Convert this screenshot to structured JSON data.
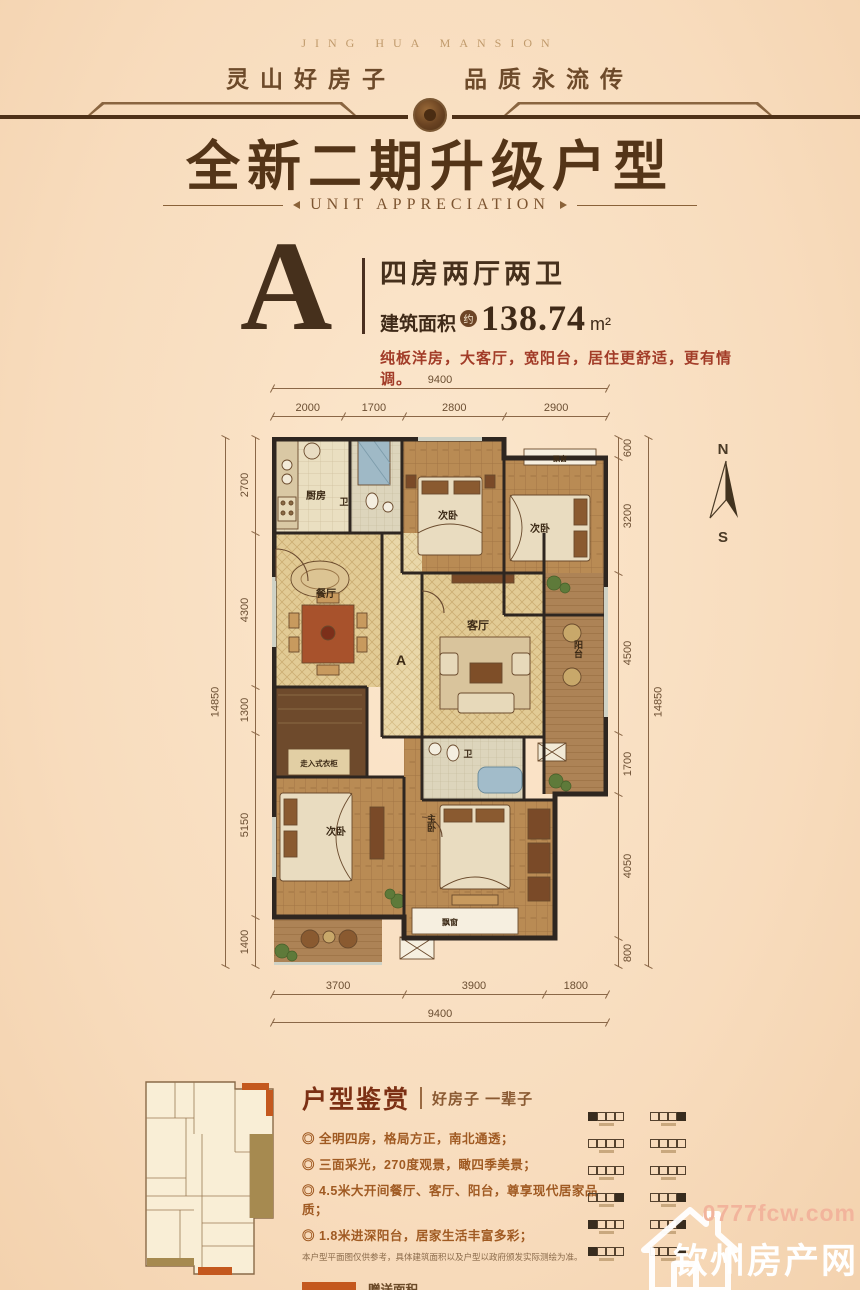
{
  "header": {
    "brand_en": "JING HUA MANSION",
    "tagline": "灵山好房子　　品质永流传",
    "title": "全新二期升级户型",
    "subtitle": "UNIT APPRECIATION"
  },
  "unit": {
    "letter": "A",
    "layout": "四房两厅两卫",
    "area_label": "建筑面积",
    "area_approx": "约",
    "area_value": "138.74",
    "area_unit": "m²",
    "description": "纯板洋房，大客厅，宽阳台，居住更舒适，更有情调。"
  },
  "floor_plan": {
    "compass": {
      "north": "N",
      "south": "S"
    },
    "dimensions": {
      "top_total": "9400",
      "top_segments": [
        "2000",
        "1700",
        "2800",
        "2900"
      ],
      "left_total": "14850",
      "left_segments": [
        "2700",
        "4300",
        "1300",
        "5150",
        "1400"
      ],
      "right_total": "14850",
      "right_segments": [
        "600",
        "3200",
        "4500",
        "1700",
        "4050",
        "800"
      ],
      "bottom_segments": [
        "3700",
        "3900",
        "1800"
      ],
      "bottom_total": "9400"
    },
    "rooms": {
      "kitchen": "厨房",
      "bath_upper": "卫",
      "bedroom_top": "次卧",
      "bedroom_topright": "次卧",
      "bay_top": "飘窗",
      "dining": "餐厅",
      "corridor": "A",
      "living": "客厅",
      "balcony": "阳台",
      "closet": "走入式衣柜",
      "bath_lower": "卫",
      "bedroom_left": "次卧",
      "master": "主卧",
      "bay_bottom": "飘窗"
    }
  },
  "appreciation": {
    "title": "户型鉴赏",
    "subtitle": "好房子 一辈子",
    "bullets": [
      "◎ 全明四房，格局方正，南北通透；",
      "◎ 三面采光，270度观景，瞰四季美景；",
      "◎ 4.5米大开间餐厅、客厅、阳台，尊享现代居家品质；",
      "◎ 1.8米进深阳台，居家生活丰富多彩；"
    ],
    "disclaimer": "本户型平面图仅供参考，具体建筑面积以及户型以政府颁发实际测绘为准。",
    "legend": [
      {
        "label": "赠送面积",
        "color": "#c4581e"
      },
      {
        "label": "计一半面积",
        "color": "#a68a50"
      }
    ]
  },
  "watermark": {
    "site_url": "0777fcw.com",
    "site_name": "钦州房产网"
  },
  "colors": {
    "background": "#f8dcbd",
    "title_brown": "#543518",
    "accent_red": "#a23c28",
    "legend_orange": "#c4581e",
    "legend_tan": "#a68a50"
  }
}
